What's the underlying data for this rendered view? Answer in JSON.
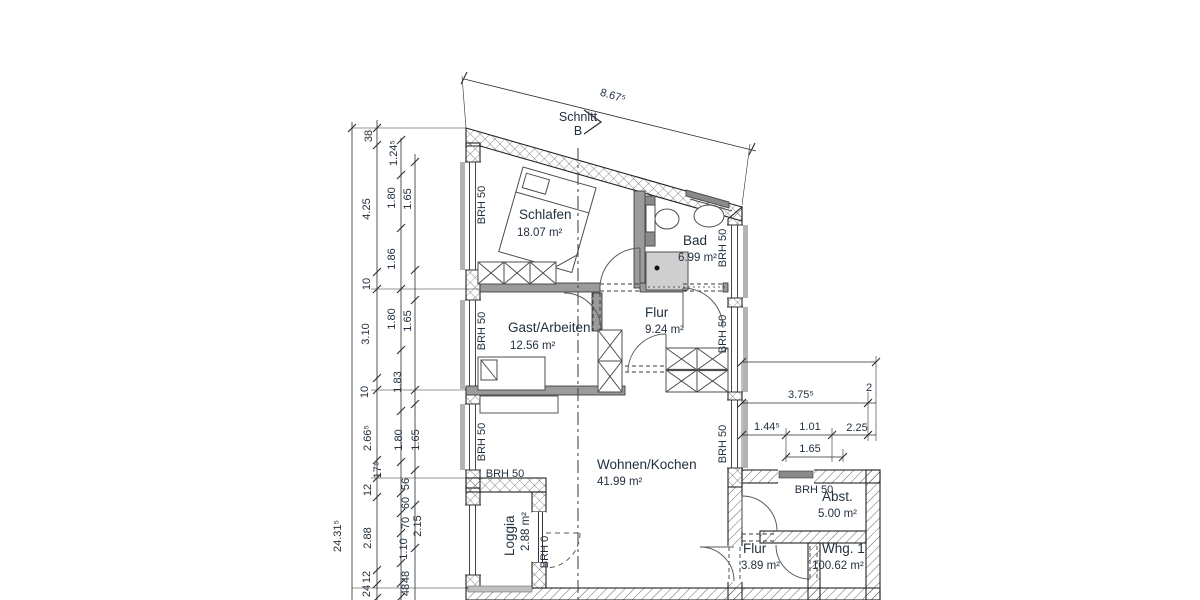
{
  "section_marker": {
    "line1": "Schnitt",
    "line2": "B",
    "x": 578,
    "y1": 121,
    "y2": 135
  },
  "rooms": [
    {
      "name": "Schlafen",
      "area": "18.07 m²",
      "x": 519,
      "y": 219,
      "ax": 517,
      "ay": 236,
      "rot": 0
    },
    {
      "name": "Bad",
      "area": "6.99 m²",
      "x": 683,
      "y": 245,
      "ax": 678,
      "ay": 261,
      "rot": 0
    },
    {
      "name": "Flur",
      "area": "9.24 m²",
      "x": 645,
      "y": 317,
      "ax": 645,
      "ay": 333,
      "rot": 0
    },
    {
      "name": "Gast/Arbeiten",
      "area": "12.56 m²",
      "x": 508,
      "y": 332,
      "ax": 510,
      "ay": 349,
      "rot": 0
    },
    {
      "name": "Wohnen/Kochen",
      "area": "41.99 m²",
      "x": 597,
      "y": 469,
      "ax": 597,
      "ay": 485,
      "rot": 0
    },
    {
      "name": "Loggia",
      "area": "2.88 m²",
      "x": 514,
      "y": 556,
      "ax": 529,
      "ay": 551,
      "rot": -90
    },
    {
      "name": "Abst.",
      "area": "5.00 m²",
      "x": 822,
      "y": 501,
      "ax": 818,
      "ay": 517,
      "rot": 0
    },
    {
      "name": "Flur",
      "area": "3.89 m²",
      "x": 743,
      "y": 553,
      "ax": 741,
      "ay": 569,
      "rot": 0
    },
    {
      "name": "Whg. 1",
      "area": "100.62 m²",
      "x": 822,
      "y": 553,
      "ax": 812,
      "ay": 569,
      "rot": 0
    }
  ],
  "brh_labels": [
    {
      "t": "BRH 50",
      "x": 485,
      "y": 205,
      "r": -90
    },
    {
      "t": "BRH 50",
      "x": 485,
      "y": 331,
      "r": -90
    },
    {
      "t": "BRH 50",
      "x": 485,
      "y": 442,
      "r": -90
    },
    {
      "t": "BRH 50",
      "x": 505,
      "y": 477,
      "r": 0
    },
    {
      "t": "BRH 0",
      "x": 548,
      "y": 552,
      "r": -90
    },
    {
      "t": "BRH 50",
      "x": 726,
      "y": 248,
      "r": -90
    },
    {
      "t": "BRH 50",
      "x": 726,
      "y": 334,
      "r": -90
    },
    {
      "t": "BRH 50",
      "x": 726,
      "y": 444,
      "r": -90
    },
    {
      "t": "BRH 50",
      "x": 814,
      "y": 493,
      "r": 0
    }
  ],
  "dimensions": [
    {
      "t": "8.67⁵",
      "x": 612,
      "y": 99,
      "r": 16
    },
    {
      "t": "38",
      "x": 372,
      "y": 136,
      "r": -90
    },
    {
      "t": "4.25",
      "x": 370,
      "y": 209,
      "r": -90
    },
    {
      "t": "10",
      "x": 370,
      "y": 284,
      "r": -90
    },
    {
      "t": "3.10",
      "x": 369,
      "y": 334,
      "r": -90
    },
    {
      "t": "10",
      "x": 368,
      "y": 392,
      "r": -90
    },
    {
      "t": "2.66⁵",
      "x": 371,
      "y": 438,
      "r": -90
    },
    {
      "t": "17⁵",
      "x": 381,
      "y": 470,
      "r": -90
    },
    {
      "t": "12",
      "x": 371,
      "y": 490,
      "r": -90
    },
    {
      "t": "2.88",
      "x": 371,
      "y": 538,
      "r": -90
    },
    {
      "t": "12",
      "x": 370,
      "y": 577,
      "r": -90
    },
    {
      "t": "24",
      "x": 370,
      "y": 591,
      "r": -90
    },
    {
      "t": "24.31⁵",
      "x": 341,
      "y": 536,
      "r": -90
    },
    {
      "t": "1.24⁵",
      "x": 397,
      "y": 153,
      "r": -90
    },
    {
      "t": "1.80",
      "x": 395,
      "y": 198,
      "r": -90
    },
    {
      "t": "1.86",
      "x": 395,
      "y": 259,
      "r": -90
    },
    {
      "t": "1.80",
      "x": 395,
      "y": 319,
      "r": -90
    },
    {
      "t": "1.83",
      "x": 401,
      "y": 382,
      "r": -90
    },
    {
      "t": "1.80",
      "x": 402,
      "y": 440,
      "r": -90
    },
    {
      "t": "56",
      "x": 409,
      "y": 484,
      "r": -90
    },
    {
      "t": "60",
      "x": 409,
      "y": 503,
      "r": -90
    },
    {
      "t": "70",
      "x": 409,
      "y": 523,
      "r": -90
    },
    {
      "t": "1.10",
      "x": 407,
      "y": 549,
      "r": -90
    },
    {
      "t": "48",
      "x": 409,
      "y": 577,
      "r": -90
    },
    {
      "t": "48",
      "x": 409,
      "y": 590,
      "r": -90
    },
    {
      "t": "1.65",
      "x": 411,
      "y": 199,
      "r": -90
    },
    {
      "t": "1.65",
      "x": 411,
      "y": 321,
      "r": -90
    },
    {
      "t": "1.65",
      "x": 419,
      "y": 440,
      "r": -90
    },
    {
      "t": "2.15",
      "x": 421,
      "y": 526,
      "r": -90
    },
    {
      "t": "3.75⁵",
      "x": 801,
      "y": 398,
      "r": 0
    },
    {
      "t": "2",
      "x": 869,
      "y": 391,
      "r": 0
    },
    {
      "t": "1.44⁵",
      "x": 767,
      "y": 430,
      "r": 0
    },
    {
      "t": "1.01",
      "x": 810,
      "y": 430,
      "r": 0
    },
    {
      "t": "2.25",
      "x": 857,
      "y": 431,
      "r": 0
    },
    {
      "t": "1.65",
      "x": 810,
      "y": 452,
      "r": 0
    }
  ],
  "colors": {
    "line": "#2c2c2c",
    "text": "#22303f",
    "interior_wall": "#9b9b9b",
    "fixture_gray": "#8a8a8a",
    "shower_gray": "#cfcfcf",
    "sill_gray": "#b3b3b3"
  }
}
